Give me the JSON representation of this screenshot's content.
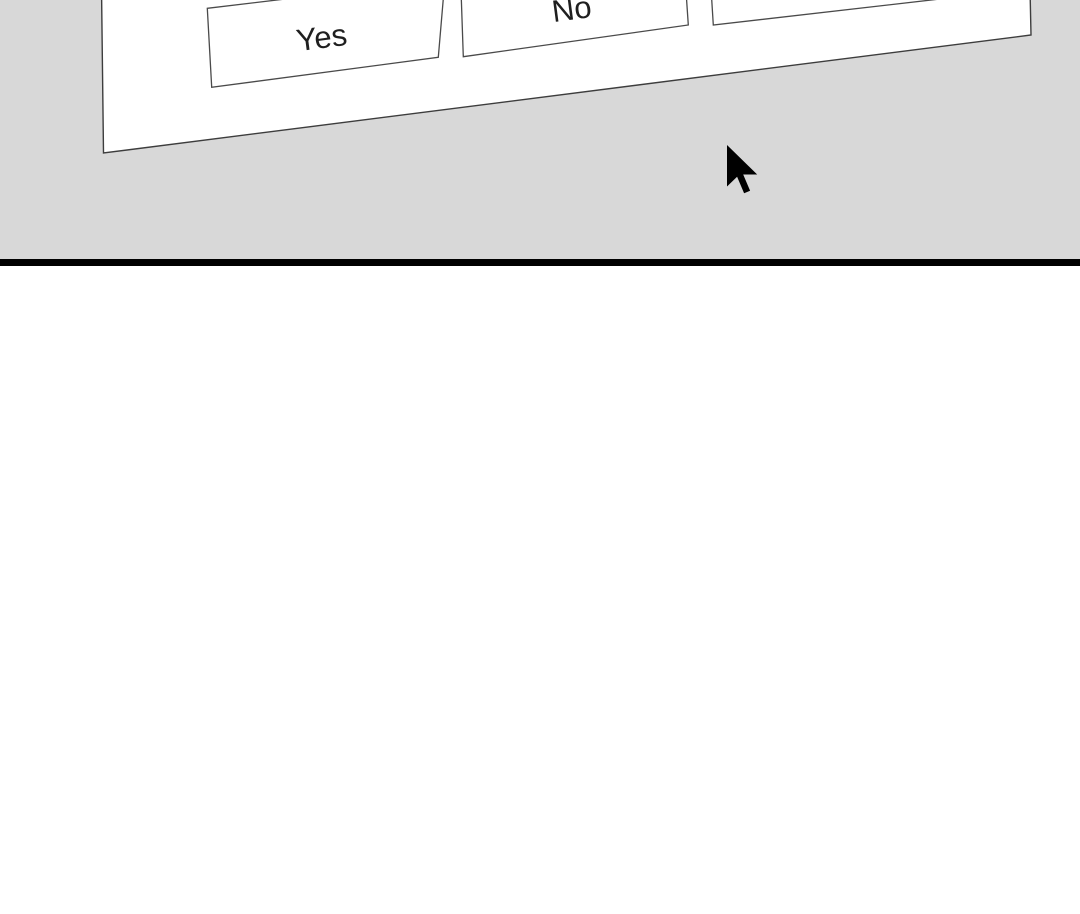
{
  "colors": {
    "page_background": "#ffffff",
    "slide_area_background": "#d8d8d8",
    "divider": "#000000",
    "panel_fill": "#ffffff",
    "panel_border": "#3d3d3d",
    "button_fill": "#ffffff",
    "button_border": "#4a4a4a",
    "button_text": "#1f1f1f",
    "cursor": "#000000"
  },
  "dialog": {
    "description": "tilted dialog panel clipped at top of screen",
    "buttons": [
      {
        "label": "Yes"
      },
      {
        "label": "No"
      },
      {
        "label": ""
      }
    ]
  },
  "cursor": {
    "icon": "arrow-cursor"
  }
}
